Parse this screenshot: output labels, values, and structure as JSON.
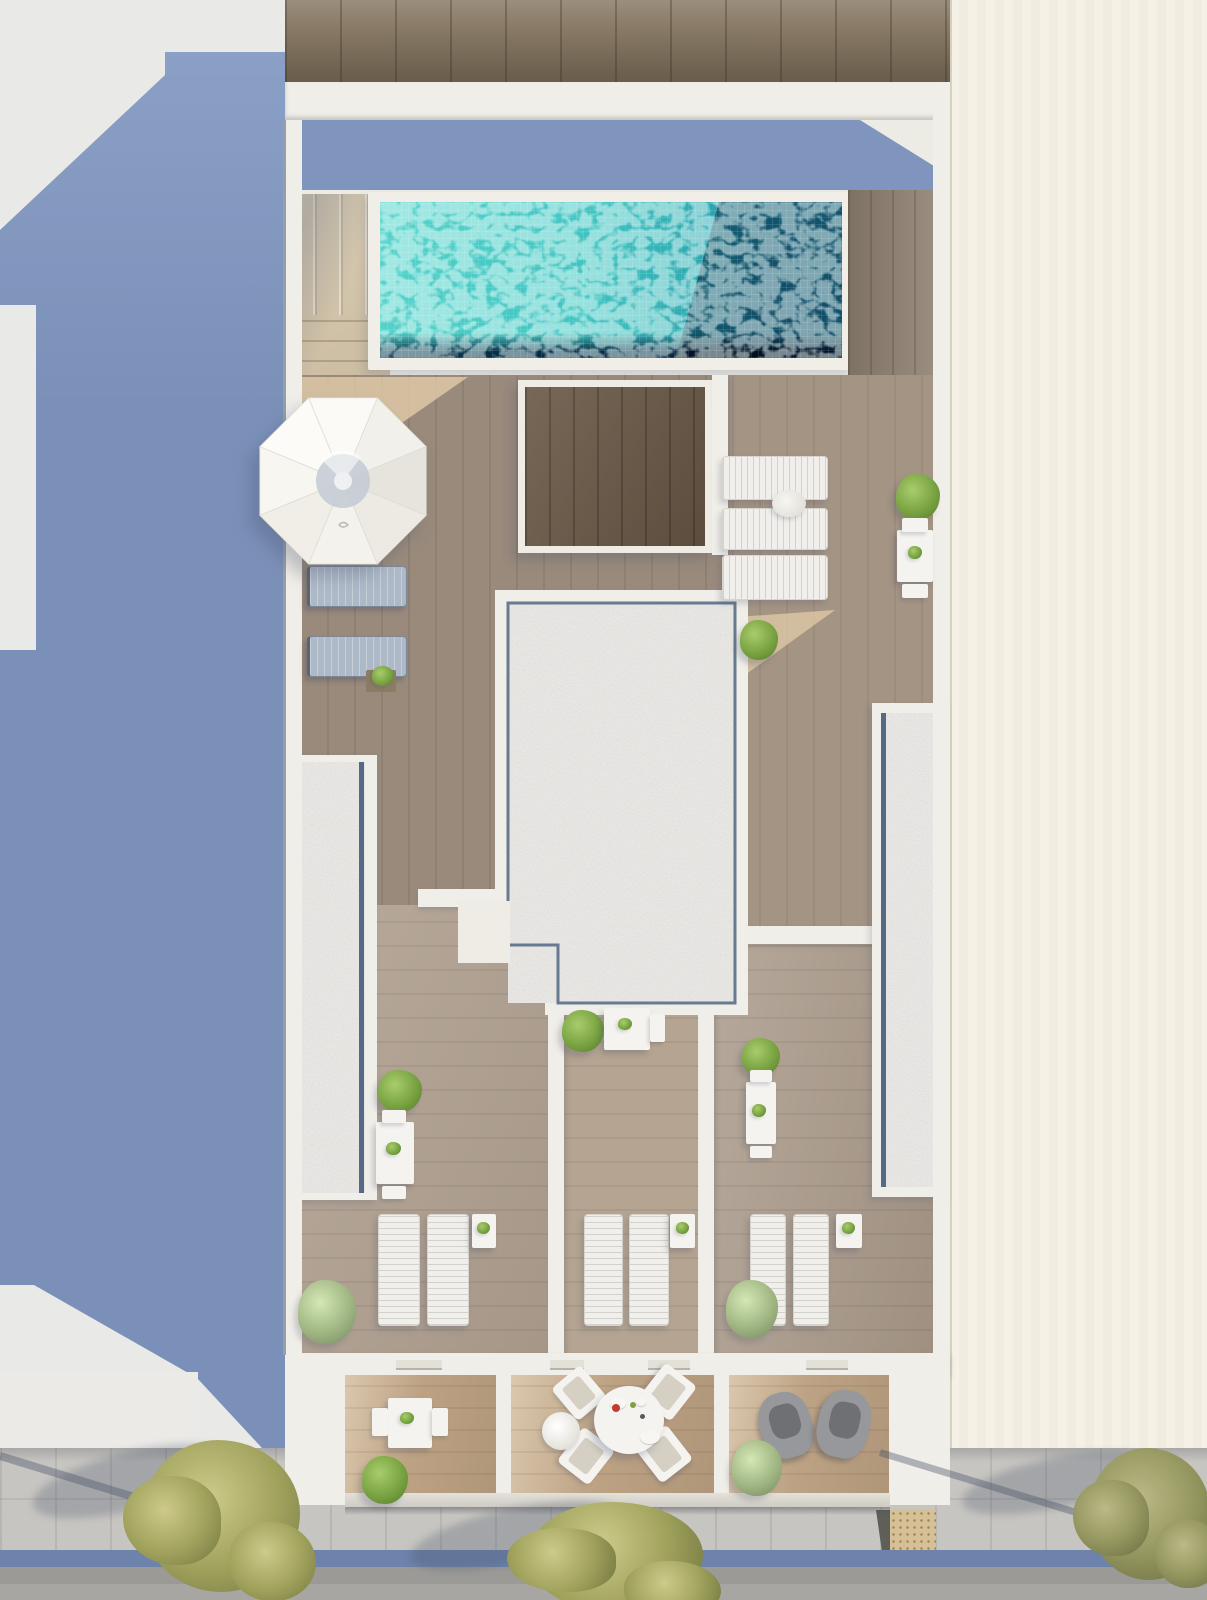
{
  "scene": {
    "type": "architectural-3d-render",
    "view": "aerial top-down of residential building rooftop terraces with swimming pool",
    "lighting": "daylight, sun from upper right, long blue shadows cast to lower left",
    "street_side": "bottom, with sidewalk, curb bike lane strip, road and three trees"
  },
  "palette": {
    "cream": "#f5f0e4",
    "neighbor-gray": "#e9e9e7",
    "shadow-blue": "#7b90b8",
    "shadow-blue-light": "#8da2c8",
    "wall-white": "#f0eee8",
    "deck-white": "#edebe4",
    "sun-beige": "#ddc7a6",
    "wood-top": "#8a7c68",
    "wood-deck": "#998a7c",
    "wood-walnut": "#6d5b49",
    "wood-terr-a": "#b0a090",
    "wood-terr-b": "#b5a491",
    "wood-terr-c": "#ac9c8c",
    "wood-balcony": "#bda284",
    "gravel": "#cac8c4",
    "glass-blue": "#3b5574",
    "pool-aqua": "#40c3c0",
    "pool-navy": "#0f3e62",
    "stone-stairs": "#dacdb4",
    "lounge-white": "#f0efeb",
    "lounge-slate": "#aeb9c8",
    "furn-white": "#f4f3ef",
    "plant-hi": "#a8cc6c",
    "plant-mid": "#79a342",
    "plant-dark": "#5d8531",
    "tree-hi": "#cdca8a",
    "tree-mid": "#a2a45e",
    "tree-dark": "#7c7f45",
    "sidewalk": "#b7b5b0",
    "curb-blue": "#6d83ac",
    "asphalt": "#9b9a97",
    "tactile-tan": "#d6c096"
  },
  "inventory": {
    "swimming_pool": 1,
    "parasol": 1,
    "stair_block": 1,
    "elevated_wood_platform": 1,
    "gravel_skylight_roof": 1,
    "gravel_planters": 2,
    "sun_loungers_white": 9,
    "sun_loungers_gray": 2,
    "bistro_table_sets": 6,
    "round_dining_table": 1,
    "dining_chairs": 4,
    "armchairs": 2,
    "side_tables": 3,
    "shrubs_and_plants": 15,
    "street_trees": 3
  },
  "objects": {
    "items": [
      {
        "t": "pole-shadow",
        "x": 0,
        "y": 1452,
        "w": 240,
        "h": 8,
        "r": 17
      },
      {
        "t": "pole-shadow",
        "x": 880,
        "y": 1449,
        "w": 310,
        "h": 7,
        "r": 17
      },
      {
        "t": "shadow-blob",
        "x": 30,
        "y": 1452,
        "w": 200,
        "h": 58,
        "r": -14
      },
      {
        "t": "shadow-blob",
        "x": 408,
        "y": 1508,
        "w": 215,
        "h": 55,
        "r": -12
      },
      {
        "t": "shadow-blob",
        "x": 960,
        "y": 1458,
        "w": 190,
        "h": 50,
        "r": -12
      },
      {
        "t": "lounger",
        "v": "slate",
        "x": 307,
        "y": 566,
        "w": 100,
        "h": 41
      },
      {
        "t": "lounger",
        "v": "slate",
        "x": 307,
        "y": 636,
        "w": 100,
        "h": 41
      },
      {
        "t": "planter-box",
        "x": 366,
        "y": 670,
        "w": 30,
        "h": 22
      },
      {
        "t": "plant",
        "v": "tiny",
        "x": 372,
        "y": 666,
        "w": 22,
        "h": 20
      },
      {
        "t": "lounger",
        "v": "white h",
        "x": 722,
        "y": 456,
        "w": 106,
        "h": 44
      },
      {
        "t": "lounger",
        "v": "white h",
        "x": 722,
        "y": 508,
        "w": 106,
        "h": 42
      },
      {
        "t": "lounger",
        "v": "white h",
        "x": 722,
        "y": 555,
        "w": 106,
        "h": 45
      },
      {
        "t": "towel-table",
        "x": 772,
        "y": 490,
        "w": 34,
        "h": 27
      },
      {
        "t": "plant",
        "x": 896,
        "y": 474,
        "w": 44,
        "h": 46
      },
      {
        "t": "table-w",
        "x": 897,
        "y": 530,
        "w": 36,
        "h": 52
      },
      {
        "t": "chair-tab",
        "x": 902,
        "y": 518,
        "w": 26,
        "h": 14
      },
      {
        "t": "chair-tab",
        "x": 902,
        "y": 584,
        "w": 26,
        "h": 14
      },
      {
        "t": "plant",
        "v": "tiny",
        "x": 908,
        "y": 546,
        "w": 14,
        "h": 13
      },
      {
        "t": "plant",
        "x": 740,
        "y": 620,
        "w": 38,
        "h": 40
      },
      {
        "t": "plant",
        "x": 378,
        "y": 1070,
        "w": 44,
        "h": 42
      },
      {
        "t": "table-w",
        "x": 376,
        "y": 1122,
        "w": 38,
        "h": 62
      },
      {
        "t": "chair-tab",
        "x": 382,
        "y": 1110,
        "w": 24,
        "h": 13
      },
      {
        "t": "chair-tab",
        "x": 382,
        "y": 1186,
        "w": 24,
        "h": 13
      },
      {
        "t": "plant",
        "v": "tiny",
        "x": 386,
        "y": 1142,
        "w": 15,
        "h": 13
      },
      {
        "t": "plant",
        "v": "pale",
        "x": 298,
        "y": 1280,
        "w": 58,
        "h": 64
      },
      {
        "t": "lounger",
        "v": "white v",
        "x": 378,
        "y": 1214,
        "w": 42,
        "h": 112
      },
      {
        "t": "lounger",
        "v": "white v",
        "x": 427,
        "y": 1214,
        "w": 42,
        "h": 112
      },
      {
        "t": "table-w",
        "x": 472,
        "y": 1214,
        "w": 24,
        "h": 34
      },
      {
        "t": "plant",
        "v": "tiny",
        "x": 477,
        "y": 1222,
        "w": 13,
        "h": 12
      },
      {
        "t": "plant",
        "x": 562,
        "y": 1010,
        "w": 42,
        "h": 42
      },
      {
        "t": "table-w",
        "x": 604,
        "y": 1008,
        "w": 46,
        "h": 42
      },
      {
        "t": "chair-tab",
        "x": 650,
        "y": 1014,
        "w": 15,
        "h": 28
      },
      {
        "t": "plant",
        "v": "tiny",
        "x": 618,
        "y": 1018,
        "w": 14,
        "h": 12
      },
      {
        "t": "lounger",
        "v": "white v",
        "x": 584,
        "y": 1214,
        "w": 39,
        "h": 112
      },
      {
        "t": "lounger",
        "v": "white v",
        "x": 629,
        "y": 1214,
        "w": 40,
        "h": 112
      },
      {
        "t": "table-w",
        "x": 670,
        "y": 1214,
        "w": 25,
        "h": 34
      },
      {
        "t": "plant",
        "v": "tiny",
        "x": 676,
        "y": 1222,
        "w": 13,
        "h": 12
      },
      {
        "t": "plant",
        "x": 742,
        "y": 1038,
        "w": 38,
        "h": 38
      },
      {
        "t": "table-w",
        "x": 746,
        "y": 1082,
        "w": 30,
        "h": 62
      },
      {
        "t": "chair-tab",
        "x": 750,
        "y": 1070,
        "w": 22,
        "h": 12
      },
      {
        "t": "chair-tab",
        "x": 750,
        "y": 1146,
        "w": 22,
        "h": 12
      },
      {
        "t": "plant",
        "v": "tiny",
        "x": 752,
        "y": 1104,
        "w": 14,
        "h": 13
      },
      {
        "t": "lounger",
        "v": "white v",
        "x": 750,
        "y": 1214,
        "w": 36,
        "h": 112
      },
      {
        "t": "lounger",
        "v": "white v",
        "x": 793,
        "y": 1214,
        "w": 36,
        "h": 112
      },
      {
        "t": "table-w",
        "x": 836,
        "y": 1214,
        "w": 26,
        "h": 34
      },
      {
        "t": "plant",
        "v": "tiny",
        "x": 842,
        "y": 1222,
        "w": 13,
        "h": 12
      },
      {
        "t": "plant",
        "v": "pale",
        "x": 726,
        "y": 1280,
        "w": 52,
        "h": 58
      },
      {
        "t": "door-tab",
        "x": 396,
        "y": 1360,
        "w": 46,
        "h": 10
      },
      {
        "t": "door-tab",
        "x": 550,
        "y": 1360,
        "w": 34,
        "h": 10
      },
      {
        "t": "door-tab",
        "x": 648,
        "y": 1360,
        "w": 42,
        "h": 10
      },
      {
        "t": "door-tab",
        "x": 806,
        "y": 1360,
        "w": 42,
        "h": 10
      },
      {
        "t": "table-w",
        "x": 388,
        "y": 1398,
        "w": 44,
        "h": 50
      },
      {
        "t": "chair-tab",
        "x": 372,
        "y": 1408,
        "w": 16,
        "h": 28
      },
      {
        "t": "chair-tab",
        "x": 432,
        "y": 1408,
        "w": 16,
        "h": 28
      },
      {
        "t": "plant",
        "v": "tiny",
        "x": 400,
        "y": 1412,
        "w": 14,
        "h": 12
      },
      {
        "t": "plant",
        "x": 362,
        "y": 1456,
        "w": 46,
        "h": 48
      },
      {
        "t": "chair-b",
        "x": 560,
        "y": 1372,
        "w": 38,
        "h": 42,
        "r": -40
      },
      {
        "t": "chair-b",
        "x": 648,
        "y": 1370,
        "w": 40,
        "h": 44,
        "r": 38
      },
      {
        "t": "chair-b",
        "x": 566,
        "y": 1434,
        "w": 40,
        "h": 44,
        "r": 38
      },
      {
        "t": "chair-b",
        "x": 644,
        "y": 1432,
        "w": 40,
        "h": 44,
        "r": -38
      },
      {
        "t": "table-round",
        "x": 594,
        "y": 1386,
        "w": 70,
        "h": 68
      },
      {
        "t": "plate",
        "x": 610,
        "y": 1398,
        "w": 16,
        "h": 11
      },
      {
        "t": "plate",
        "x": 640,
        "y": 1430,
        "w": 20,
        "h": 14
      },
      {
        "t": "plate",
        "x": 636,
        "y": 1398,
        "w": 10,
        "h": 8
      },
      {
        "t": "dot",
        "v": "red",
        "x": 612,
        "y": 1404,
        "w": 8,
        "h": 8
      },
      {
        "t": "dot",
        "v": "green",
        "x": 630,
        "y": 1402,
        "w": 6,
        "h": 6
      },
      {
        "t": "dot",
        "v": "dark",
        "x": 640,
        "y": 1414,
        "w": 5,
        "h": 5
      },
      {
        "t": "pouf",
        "x": 542,
        "y": 1412,
        "w": 38,
        "h": 38
      },
      {
        "t": "armchair",
        "x": 760,
        "y": 1392,
        "w": 52,
        "h": 66,
        "r": -16
      },
      {
        "t": "armchair",
        "x": 818,
        "y": 1390,
        "w": 52,
        "h": 68,
        "r": 12
      },
      {
        "t": "plant",
        "v": "pale",
        "x": 732,
        "y": 1440,
        "w": 50,
        "h": 56
      },
      {
        "t": "tree",
        "x": 142,
        "y": 1440,
        "w": 158,
        "h": 152
      },
      {
        "t": "tree",
        "x": 528,
        "y": 1502,
        "w": 175,
        "h": 110
      },
      {
        "t": "tree",
        "v": "dark",
        "x": 1088,
        "y": 1448,
        "w": 122,
        "h": 132
      }
    ]
  }
}
